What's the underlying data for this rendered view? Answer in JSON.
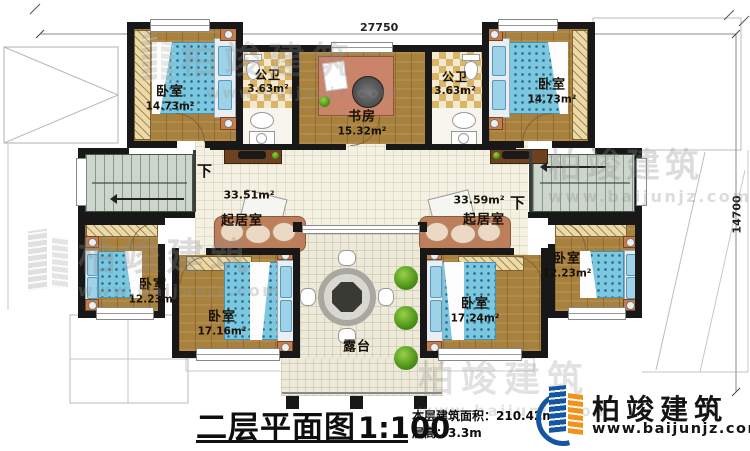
{
  "floor_plan": {
    "dimensions": {
      "top": "27750",
      "right": "14700"
    },
    "rooms": [
      {
        "name": "卧室",
        "area": "14.73m²"
      },
      {
        "name": "公卫",
        "area": "3.63m²"
      },
      {
        "name": "书房",
        "area": "15.32m²"
      },
      {
        "name": "公卫",
        "area": "3.63m²"
      },
      {
        "name": "卧室",
        "area": "14.73m²"
      },
      {
        "name": "起居室",
        "area": "33.51m²"
      },
      {
        "name": "起居室",
        "area": "33.59m²"
      },
      {
        "name": "卧室",
        "area": "12.23m²"
      },
      {
        "name": "卧室",
        "area": "12.23m²"
      },
      {
        "name": "卧室",
        "area": "17.16m²"
      },
      {
        "name": "卧室",
        "area": "17.24m²"
      },
      {
        "name": "露台",
        "area": ""
      }
    ],
    "stairs_down_label": "下",
    "title": {
      "text": "二层平面图",
      "scale": "1:100"
    },
    "info": {
      "area": "本层建筑面积：210.42m²",
      "floor_height": "层高：3.3m"
    },
    "brand": {
      "name": "柏竣建筑",
      "website": "www.baijunjz.com"
    }
  }
}
